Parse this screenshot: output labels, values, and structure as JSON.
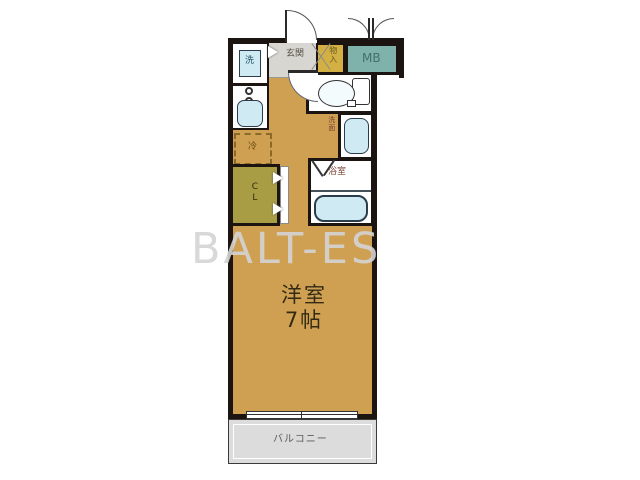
{
  "watermark": "BALT-ES",
  "plan": {
    "main_room": {
      "name_line1": "洋室",
      "name_line2": "7帖"
    },
    "balcony": {
      "label": "バルコニー"
    },
    "entrance": {
      "label": "玄関"
    },
    "storage": {
      "label": "物入"
    },
    "meter_box": {
      "label": "MB"
    },
    "wc": {
      "label": "WC"
    },
    "washroom": {
      "label": "洗面"
    },
    "bathroom": {
      "label": "浴室"
    },
    "closet": {
      "label": "CL"
    },
    "laundry": {
      "label": "洗"
    },
    "refrigerator": {
      "label": "冷"
    }
  },
  "colors": {
    "room_fill": "#CFA052",
    "storage_fill": "#D2B044",
    "closet_fill": "#A89C44",
    "meter_box_fill": "#7EB2AB",
    "balcony_fill": "#DCDCDC",
    "entrance_fill": "#D8D6D0",
    "fixture_fill": "#CFEAF3",
    "wall": "#1C1410"
  }
}
